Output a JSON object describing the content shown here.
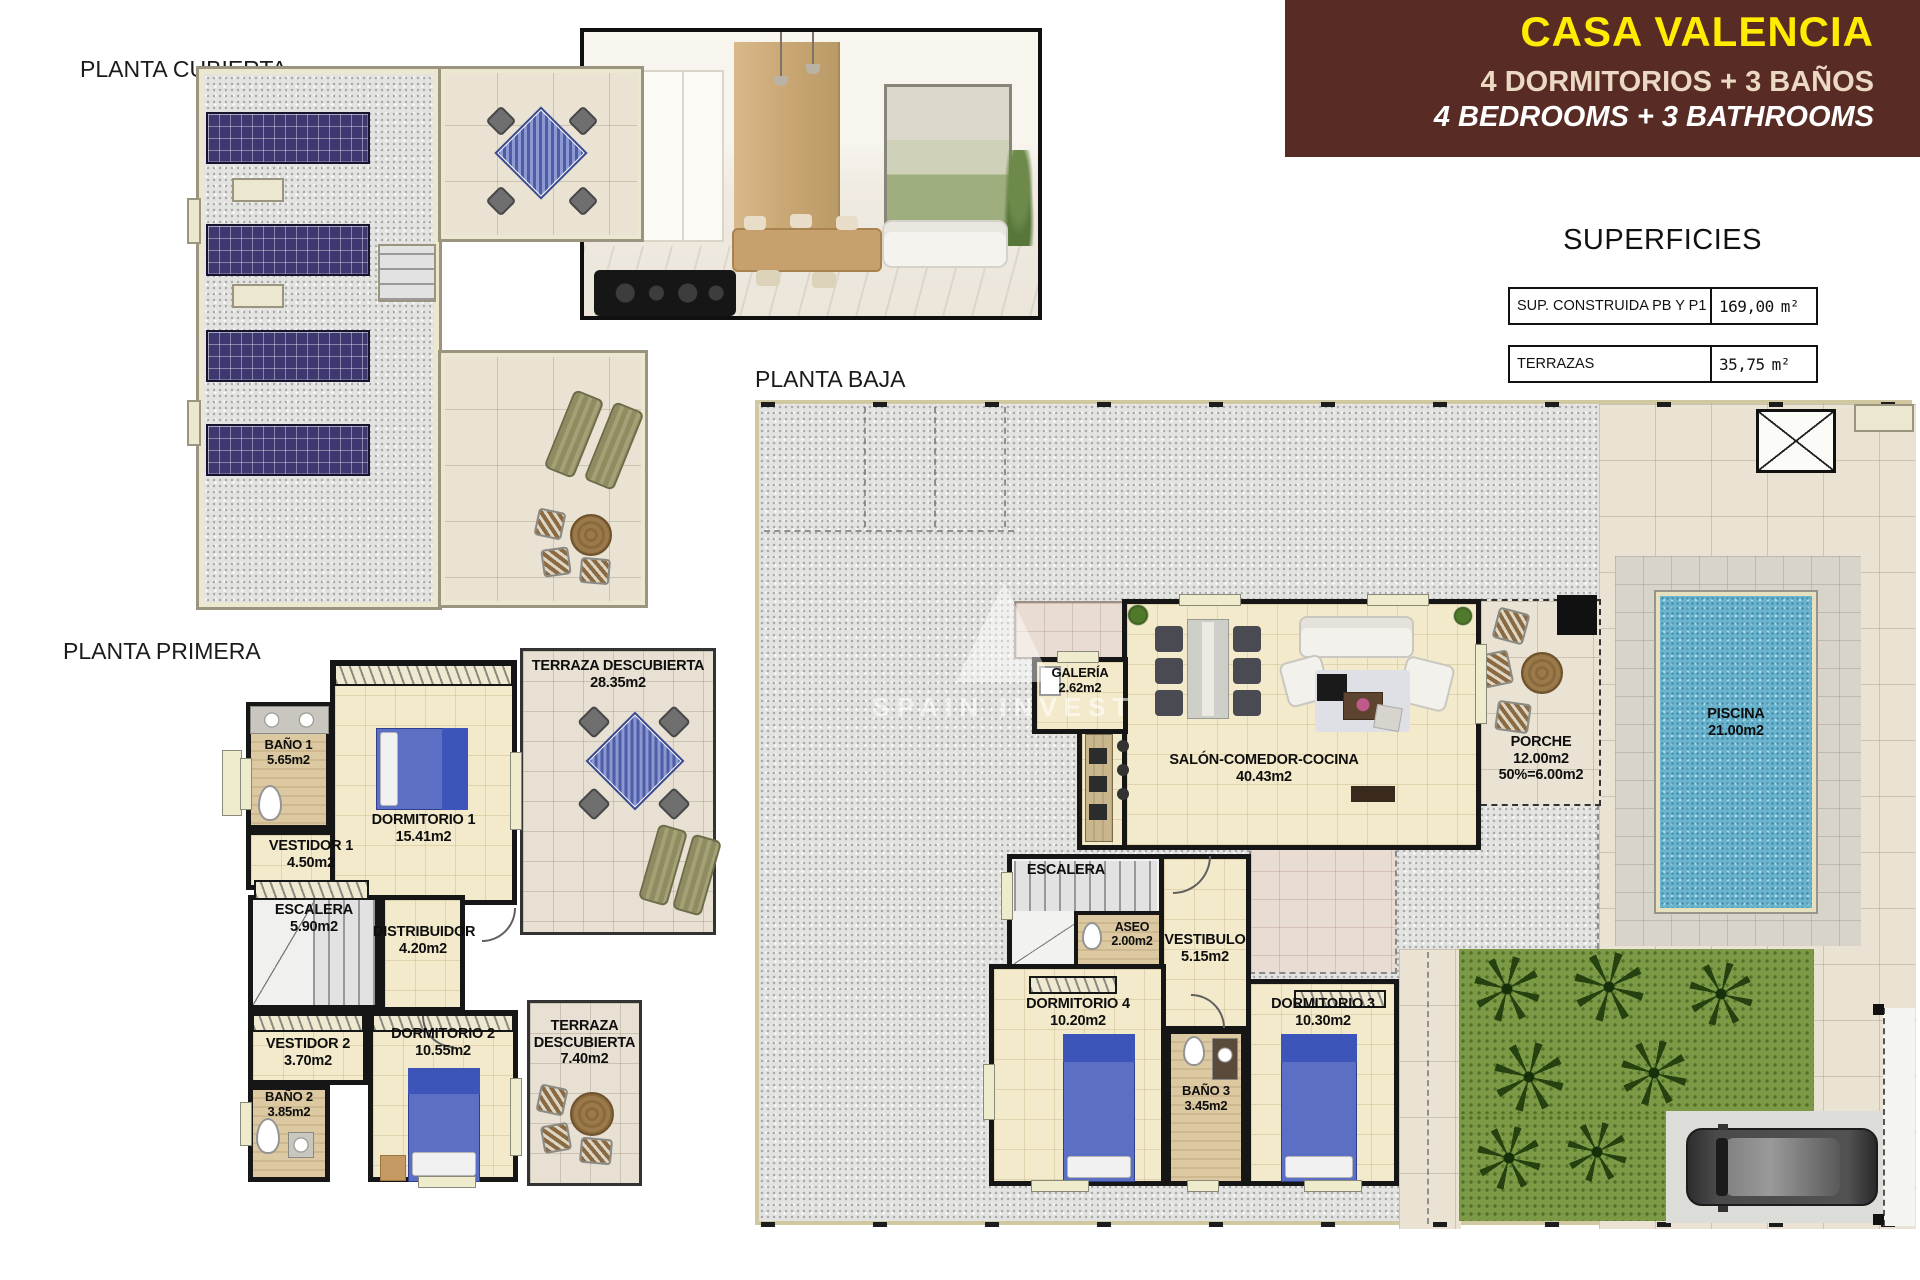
{
  "banner": {
    "title": "CASA VALENCIA",
    "subtitle_es": "4 DORMITORIOS + 3 BAÑOS",
    "subtitle_en": "4 BEDROOMS + 3 BATHROOMS"
  },
  "colors": {
    "banner_bg": "#582c24",
    "banner_title": "#ffec00",
    "banner_subtitle": "#ecd9c3",
    "pool_water": "#6ab5cd",
    "garden_green": "#7c9a45",
    "solar_panel": "#3e3870",
    "bed_blue": "#5b6fc5"
  },
  "superficies": {
    "title": "SUPERFICIES",
    "rows": [
      {
        "label": "SUP. CONSTRUIDA PB Y P1",
        "value": "169,00",
        "unit": "m²"
      },
      {
        "label": "TERRAZAS",
        "value": "35,75",
        "unit": "m²"
      },
      {
        "label": "TOTAL",
        "value": "204,75",
        "unit": "m²"
      }
    ]
  },
  "watermark": "SPAIN INVEST",
  "plans": {
    "cubierta": {
      "title": "PLANTA CUBIERTA"
    },
    "primera": {
      "title": "PLANTA PRIMERA",
      "rooms": {
        "bano1": {
          "name": "BAÑO 1",
          "area": "5.65m2"
        },
        "vestidor1": {
          "name": "VESTIDOR 1",
          "area": "4.50m2"
        },
        "dormitorio1": {
          "name": "DORMITORIO 1",
          "area": "15.41m2"
        },
        "terraza1": {
          "name": "TERRAZA DESCUBIERTA",
          "area": "28.35m2"
        },
        "escalera": {
          "name": "ESCALERA",
          "area": "5.90m2"
        },
        "distribuidor": {
          "name": "DISTRIBUIDOR",
          "area": "4.20m2"
        },
        "vestidor2": {
          "name": "VESTIDOR 2",
          "area": "3.70m2"
        },
        "bano2": {
          "name": "BAÑO 2",
          "area": "3.85m2"
        },
        "dormitorio2": {
          "name": "DORMITORIO 2",
          "area": "10.55m2"
        },
        "terraza2": {
          "name": "TERRAZA DESCUBIERTA",
          "area": "7.40m2"
        }
      }
    },
    "baja": {
      "title": "PLANTA BAJA",
      "rooms": {
        "galeria": {
          "name": "GALERÍA",
          "area": "2.62m2"
        },
        "salon": {
          "name": "SALÓN-COMEDOR-COCINA",
          "area": "40.43m2"
        },
        "porche": {
          "name": "PORCHE",
          "area": "12.00m2",
          "area2": "50%=6.00m2"
        },
        "piscina": {
          "name": "PISCINA",
          "area": "21.00m2"
        },
        "escalera": {
          "name": "ESCALERA"
        },
        "aseo": {
          "name": "ASEO",
          "area": "2.00m2"
        },
        "vestibulo": {
          "name": "VESTIBULO",
          "area": "5.15m2"
        },
        "dormitorio4": {
          "name": "DORMITORIO 4",
          "area": "10.20m2"
        },
        "bano3": {
          "name": "BAÑO 3",
          "area": "3.45m2"
        },
        "dormitorio3": {
          "name": "DORMITORIO 3",
          "area": "10.30m2"
        }
      }
    }
  }
}
